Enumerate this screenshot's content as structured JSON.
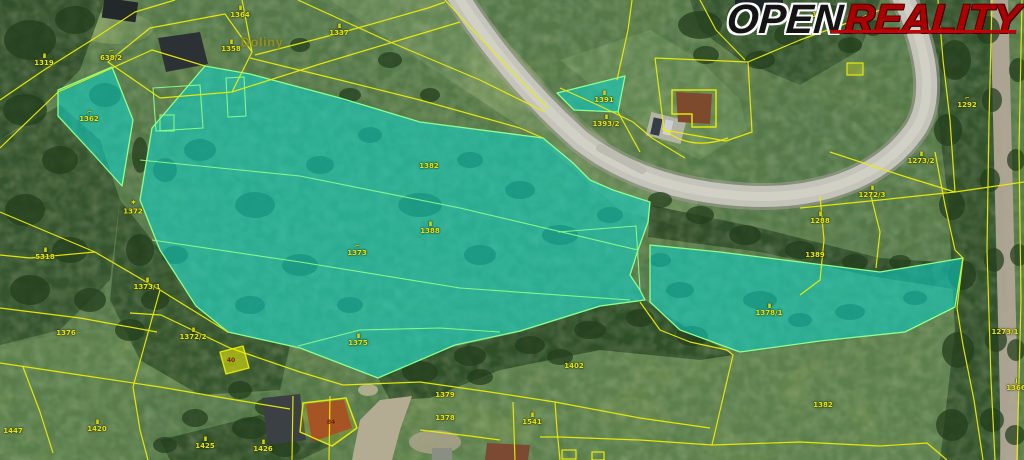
{
  "logo": {
    "open": "OPEN",
    "reality": "REALITY",
    "open_color": "#141414",
    "reality_color": "#a90000",
    "underline_color": "#c40000"
  },
  "map": {
    "place_label": "Doliny",
    "colors": {
      "parcel_line": "#e9ec08",
      "highlight_fill": "#0dd3c7",
      "highlight_border": "#8dff8d",
      "label_text": "#e6e90c"
    },
    "building_numbers": [
      {
        "x": 231,
        "y": 361,
        "text": "40"
      },
      {
        "x": 331,
        "y": 423,
        "text": "84"
      }
    ],
    "labels": [
      {
        "x": 240,
        "y": 12,
        "sym": "II",
        "text": "1364"
      },
      {
        "x": 231,
        "y": 46,
        "sym": "II",
        "text": "1358"
      },
      {
        "x": 111,
        "y": 55,
        "sym": "⌐",
        "text": "638/2"
      },
      {
        "x": 44,
        "y": 60,
        "sym": "II",
        "text": "1319"
      },
      {
        "x": 339,
        "y": 30,
        "sym": "II",
        "text": "1337"
      },
      {
        "x": 89,
        "y": 116,
        "sym": "⌐",
        "text": "1362"
      },
      {
        "x": 133,
        "y": 208,
        "sym": "*",
        "text": "1372"
      },
      {
        "x": 45,
        "y": 254,
        "sym": "II",
        "text": "5318"
      },
      {
        "x": 147,
        "y": 284,
        "sym": "II",
        "text": "1373/1"
      },
      {
        "x": 429,
        "y": 166,
        "text": "1382"
      },
      {
        "x": 430,
        "y": 228,
        "sym": "II",
        "text": "1388"
      },
      {
        "x": 357,
        "y": 250,
        "sym": "⌐",
        "text": "1373"
      },
      {
        "x": 604,
        "y": 97,
        "sym": "II",
        "text": "1391"
      },
      {
        "x": 606,
        "y": 121,
        "sym": "II",
        "text": "1393/2"
      },
      {
        "x": 822,
        "y": 12,
        "sym": "⌐",
        "text": "1291"
      },
      {
        "x": 967,
        "y": 102,
        "sym": "⌐",
        "text": "1292"
      },
      {
        "x": 921,
        "y": 158,
        "sym": "II",
        "text": "1273/2"
      },
      {
        "x": 872,
        "y": 192,
        "sym": "II",
        "text": "1272/3"
      },
      {
        "x": 820,
        "y": 218,
        "sym": "II",
        "text": "1288"
      },
      {
        "x": 815,
        "y": 255,
        "text": "1389"
      },
      {
        "x": 769,
        "y": 310,
        "sym": "II",
        "text": "1378/1"
      },
      {
        "x": 1005,
        "y": 332,
        "text": "1273/1"
      },
      {
        "x": 1016,
        "y": 385,
        "sym": "I",
        "text": "1366"
      },
      {
        "x": 823,
        "y": 405,
        "text": "1382"
      },
      {
        "x": 193,
        "y": 334,
        "sym": "II",
        "text": "1372/2"
      },
      {
        "x": 358,
        "y": 340,
        "sym": "II",
        "text": "1375"
      },
      {
        "x": 66,
        "y": 333,
        "text": "1376"
      },
      {
        "x": 13,
        "y": 431,
        "text": "1447"
      },
      {
        "x": 97,
        "y": 426,
        "sym": "II",
        "text": "1420"
      },
      {
        "x": 445,
        "y": 395,
        "text": "1379"
      },
      {
        "x": 445,
        "y": 418,
        "text": "1378"
      },
      {
        "x": 532,
        "y": 419,
        "sym": "II",
        "text": "1541"
      },
      {
        "x": 205,
        "y": 443,
        "sym": "II",
        "text": "1425"
      },
      {
        "x": 263,
        "y": 446,
        "sym": "II",
        "text": "1426"
      },
      {
        "x": 574,
        "y": 366,
        "text": "1402"
      }
    ]
  }
}
